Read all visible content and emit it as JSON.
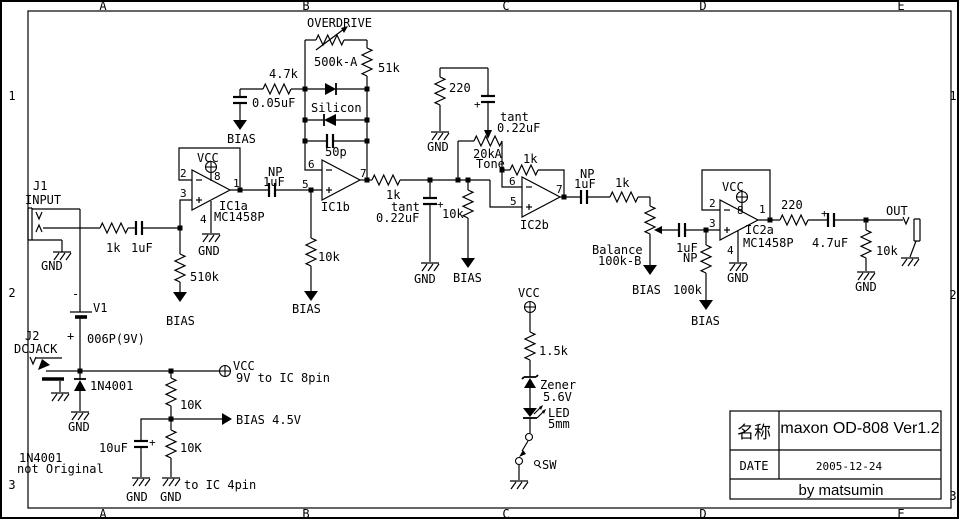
{
  "canvas": {
    "width": 960,
    "height": 520,
    "background": "#ffffff",
    "ink": "#000000"
  },
  "frame": {
    "cols": [
      "A",
      "B",
      "C",
      "D",
      "E"
    ],
    "rows": [
      "1",
      "2",
      "3"
    ]
  },
  "title_block": {
    "name_label": "名称",
    "title": "maxon OD-808 Ver1.2",
    "date_label": "DATE",
    "date": "2005-12-24",
    "credit": "by matsumin"
  },
  "labels": [
    {
      "n": "j1-ref",
      "t": "J1",
      "x": 33,
      "y": 190
    },
    {
      "n": "j1-name",
      "t": "INPUT",
      "x": 25,
      "y": 204
    },
    {
      "n": "j1-gnd",
      "t": "GND",
      "x": 41,
      "y": 270
    },
    {
      "n": "r-in-value",
      "t": "1k",
      "x": 106,
      "y": 252
    },
    {
      "n": "c-in-value",
      "t": "1uF",
      "x": 131,
      "y": 252
    },
    {
      "n": "r-bias-in",
      "t": "510k",
      "x": 190,
      "y": 281
    },
    {
      "n": "bias-510k",
      "t": "BIAS",
      "x": 166,
      "y": 325
    },
    {
      "n": "bat-minus",
      "t": "-",
      "x": 72,
      "y": 298
    },
    {
      "n": "bat-ref",
      "t": "V1",
      "x": 93,
      "y": 312
    },
    {
      "n": "bat-plus",
      "t": "+",
      "x": 67,
      "y": 340
    },
    {
      "n": "bat-type",
      "t": "006P(9V)",
      "x": 87,
      "y": 343
    },
    {
      "n": "j2-ref",
      "t": "J2",
      "x": 25,
      "y": 340
    },
    {
      "n": "j2-name",
      "t": "DCJACK",
      "x": 14,
      "y": 353
    },
    {
      "n": "d-prot",
      "t": "1N4001",
      "x": 90,
      "y": 390
    },
    {
      "n": "d-prot-gnd",
      "t": "GND",
      "x": 68,
      "y": 431
    },
    {
      "n": "vcc-main",
      "t": "VCC",
      "x": 233,
      "y": 370
    },
    {
      "n": "vcc-note",
      "t": "9V to IC 8pin",
      "x": 236,
      "y": 382
    },
    {
      "n": "r-div1",
      "t": "10K",
      "x": 180,
      "y": 409
    },
    {
      "n": "bias-45",
      "t": "BIAS 4.5V",
      "x": 236,
      "y": 424
    },
    {
      "n": "c-bias",
      "t": "10uF",
      "x": 99,
      "y": 452
    },
    {
      "n": "c-bias-plus",
      "t": "+",
      "x": 149,
      "y": 446,
      "s": 11
    },
    {
      "n": "r-div2",
      "t": "10K",
      "x": 180,
      "y": 452
    },
    {
      "n": "gnd-cbias",
      "t": "GND",
      "x": 126,
      "y": 501
    },
    {
      "n": "gnd-div",
      "t": "GND",
      "x": 160,
      "y": 501
    },
    {
      "n": "pin4-note",
      "t": "to IC 4pin",
      "x": 184,
      "y": 489
    },
    {
      "n": "note-1n4001",
      "t": "1N4001",
      "x": 19,
      "y": 462
    },
    {
      "n": "note-orig",
      "t": "not Original",
      "x": 17,
      "y": 473
    },
    {
      "n": "ic1a-vcc",
      "t": "VCC",
      "x": 197,
      "y": 162
    },
    {
      "n": "ic1a-p8",
      "t": "8",
      "x": 214,
      "y": 180,
      "s": 11
    },
    {
      "n": "ic1a-p2",
      "t": "2",
      "x": 180,
      "y": 177,
      "s": 11
    },
    {
      "n": "ic1a-p3",
      "t": "3",
      "x": 180,
      "y": 197,
      "s": 11
    },
    {
      "n": "ic1a-p1",
      "t": "1",
      "x": 233,
      "y": 187,
      "s": 11
    },
    {
      "n": "ic1a-p4",
      "t": "4",
      "x": 200,
      "y": 223,
      "s": 11
    },
    {
      "n": "ic1a-ref",
      "t": "IC1a",
      "x": 219,
      "y": 210
    },
    {
      "n": "ic1a-part",
      "t": "MC1458P",
      "x": 214,
      "y": 221
    },
    {
      "n": "ic1a-gnd",
      "t": "GND",
      "x": 198,
      "y": 255
    },
    {
      "n": "c-np1-np",
      "t": "NP",
      "x": 268,
      "y": 176
    },
    {
      "n": "c-np1-val",
      "t": "1uF",
      "x": 263,
      "y": 186
    },
    {
      "n": "od-title",
      "t": "OVERDRIVE",
      "x": 307,
      "y": 27
    },
    {
      "n": "od-val",
      "t": "500k-A",
      "x": 314,
      "y": 66
    },
    {
      "n": "r-51k",
      "t": "51k",
      "x": 378,
      "y": 72
    },
    {
      "n": "r-47k",
      "t": "4.7k",
      "x": 269,
      "y": 78
    },
    {
      "n": "c-005",
      "t": "0.05uF",
      "x": 252,
      "y": 107
    },
    {
      "n": "bias-005",
      "t": "BIAS",
      "x": 227,
      "y": 143
    },
    {
      "n": "d-silicon",
      "t": "Silicon",
      "x": 311,
      "y": 112
    },
    {
      "n": "c-50p",
      "t": "50p",
      "x": 325,
      "y": 156
    },
    {
      "n": "ic1b-p6",
      "t": "6",
      "x": 308,
      "y": 168,
      "s": 11
    },
    {
      "n": "ic1b-p5",
      "t": "5",
      "x": 302,
      "y": 188,
      "s": 11
    },
    {
      "n": "ic1b-p7",
      "t": "7",
      "x": 360,
      "y": 177,
      "s": 11
    },
    {
      "n": "ic1b-ref",
      "t": "IC1b",
      "x": 321,
      "y": 211
    },
    {
      "n": "r-10k-b1",
      "t": "10k",
      "x": 318,
      "y": 261
    },
    {
      "n": "bias-b1",
      "t": "BIAS",
      "x": 292,
      "y": 313
    },
    {
      "n": "r-1k-mid",
      "t": "1k",
      "x": 386,
      "y": 199
    },
    {
      "n": "c-tant1-t",
      "t": "tant",
      "x": 391,
      "y": 211
    },
    {
      "n": "c-tant1-v",
      "t": "0.22uF",
      "x": 376,
      "y": 222
    },
    {
      "n": "c-tant1-p",
      "t": "+",
      "x": 437,
      "y": 208,
      "s": 11
    },
    {
      "n": "gnd-tant1",
      "t": "GND",
      "x": 414,
      "y": 283
    },
    {
      "n": "r-10k-mid",
      "t": "10k",
      "x": 442,
      "y": 218
    },
    {
      "n": "bias-mid",
      "t": "BIAS",
      "x": 453,
      "y": 282
    },
    {
      "n": "r-220-tone",
      "t": "220",
      "x": 449,
      "y": 92
    },
    {
      "n": "gnd-tone",
      "t": "GND",
      "x": 427,
      "y": 151
    },
    {
      "n": "c-tant2-t",
      "t": "tant",
      "x": 500,
      "y": 121
    },
    {
      "n": "c-tant2-v",
      "t": "0.22uF",
      "x": 497,
      "y": 132
    },
    {
      "n": "c-tant2-p",
      "t": "+",
      "x": 474,
      "y": 108,
      "s": 11
    },
    {
      "n": "pot-tone-val",
      "t": "20kA",
      "x": 473,
      "y": 158
    },
    {
      "n": "pot-tone",
      "t": "Tone",
      "x": 476,
      "y": 168
    },
    {
      "n": "r-1k-fb",
      "t": "1k",
      "x": 523,
      "y": 163
    },
    {
      "n": "ic2b-p6",
      "t": "6",
      "x": 509,
      "y": 185,
      "s": 11
    },
    {
      "n": "ic2b-p5",
      "t": "5",
      "x": 510,
      "y": 205,
      "s": 11
    },
    {
      "n": "ic2b-p7",
      "t": "7",
      "x": 556,
      "y": 193,
      "s": 11
    },
    {
      "n": "ic2b-ref",
      "t": "IC2b",
      "x": 520,
      "y": 229
    },
    {
      "n": "c-np2-np",
      "t": "NP",
      "x": 580,
      "y": 178
    },
    {
      "n": "c-np2-val",
      "t": "1uF",
      "x": 574,
      "y": 188
    },
    {
      "n": "r-1k-post",
      "t": "1k",
      "x": 615,
      "y": 187
    },
    {
      "n": "pot-bal",
      "t": "Balance",
      "x": 592,
      "y": 254
    },
    {
      "n": "pot-bal-val",
      "t": "100k-B",
      "x": 598,
      "y": 265
    },
    {
      "n": "bias-bal",
      "t": "BIAS",
      "x": 632,
      "y": 294
    },
    {
      "n": "c-np3-val",
      "t": "1uF",
      "x": 676,
      "y": 252
    },
    {
      "n": "c-np3-np",
      "t": "NP",
      "x": 683,
      "y": 262
    },
    {
      "n": "r-100k",
      "t": "100k",
      "x": 673,
      "y": 294
    },
    {
      "n": "bias-100k",
      "t": "BIAS",
      "x": 691,
      "y": 325
    },
    {
      "n": "ic2a-vcc",
      "t": "VCC",
      "x": 722,
      "y": 191
    },
    {
      "n": "ic2a-p8",
      "t": "8",
      "x": 737,
      "y": 214,
      "s": 11
    },
    {
      "n": "ic2a-p2",
      "t": "2",
      "x": 709,
      "y": 207,
      "s": 11
    },
    {
      "n": "ic2a-p3",
      "t": "3",
      "x": 709,
      "y": 227,
      "s": 11
    },
    {
      "n": "ic2a-p1",
      "t": "1",
      "x": 759,
      "y": 213,
      "s": 11
    },
    {
      "n": "ic2a-p4",
      "t": "4",
      "x": 727,
      "y": 254,
      "s": 11
    },
    {
      "n": "ic2a-ref",
      "t": "IC2a",
      "x": 745,
      "y": 234
    },
    {
      "n": "ic2a-part",
      "t": "MC1458P",
      "x": 743,
      "y": 247
    },
    {
      "n": "ic2a-gnd",
      "t": "GND",
      "x": 727,
      "y": 282
    },
    {
      "n": "r-220-out",
      "t": "220",
      "x": 781,
      "y": 209
    },
    {
      "n": "c-47-plus",
      "t": "+",
      "x": 821,
      "y": 217,
      "s": 11
    },
    {
      "n": "c-47-val",
      "t": "4.7uF",
      "x": 812,
      "y": 247
    },
    {
      "n": "r-10k-out",
      "t": "10k",
      "x": 876,
      "y": 255
    },
    {
      "n": "gnd-out10k",
      "t": "GND",
      "x": 855,
      "y": 291
    },
    {
      "n": "out-name",
      "t": "OUT",
      "x": 886,
      "y": 215
    },
    {
      "n": "vcc-led",
      "t": "VCC",
      "x": 518,
      "y": 297
    },
    {
      "n": "r-15k",
      "t": "1.5k",
      "x": 539,
      "y": 355
    },
    {
      "n": "zener-name",
      "t": "Zener",
      "x": 540,
      "y": 389
    },
    {
      "n": "zener-v",
      "t": "5.6V",
      "x": 543,
      "y": 401
    },
    {
      "n": "led-name",
      "t": "LED",
      "x": 548,
      "y": 417
    },
    {
      "n": "led-size",
      "t": "5mm",
      "x": 548,
      "y": 428
    },
    {
      "n": "sw-name",
      "t": "SW",
      "x": 542,
      "y": 469
    }
  ]
}
